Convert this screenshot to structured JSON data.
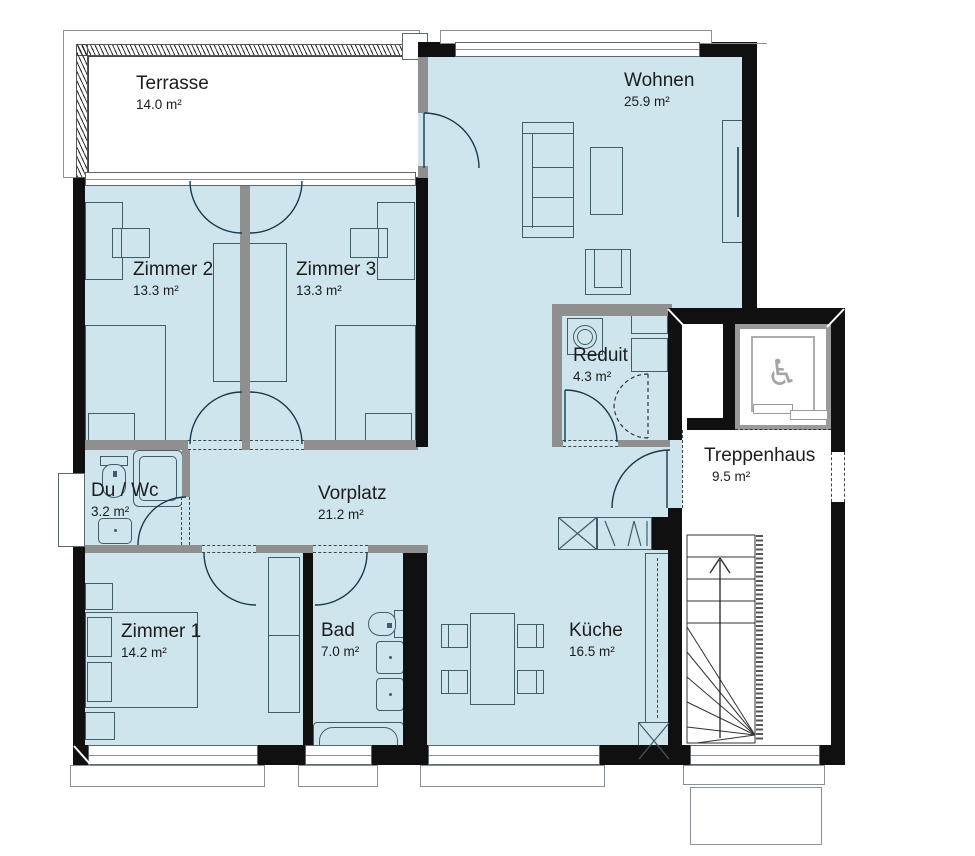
{
  "plan": {
    "type": "apartment-floor-plan",
    "rooms": [
      {
        "name": "Terrasse",
        "area": "14.0 m²"
      },
      {
        "name": "Wohnen",
        "area": "25.9 m²"
      },
      {
        "name": "Zimmer 2",
        "area": "13.3 m²"
      },
      {
        "name": "Zimmer 3",
        "area": "13.3 m²"
      },
      {
        "name": "Reduit",
        "area": "4.3 m²"
      },
      {
        "name": "Treppenhaus",
        "area": "9.5 m²"
      },
      {
        "name": "Du / Wc",
        "area": "3.2 m²"
      },
      {
        "name": "Vorplatz",
        "area": "21.2 m²"
      },
      {
        "name": "Zimmer 1",
        "area": "14.2 m²"
      },
      {
        "name": "Bad",
        "area": "7.0 m²"
      },
      {
        "name": "Küche",
        "area": "16.5 m²"
      }
    ],
    "icons": {
      "wheelchair": "♿"
    },
    "colors": {
      "floor": "#cfe5ed",
      "exterior_wall": "#101010",
      "interior_wall": "#8f8f8f",
      "furniture_line": "#3f5d69",
      "door_arc": "#173a4c",
      "elevator_gray": "#9a9a9a",
      "text": "#1c1c1c"
    }
  }
}
